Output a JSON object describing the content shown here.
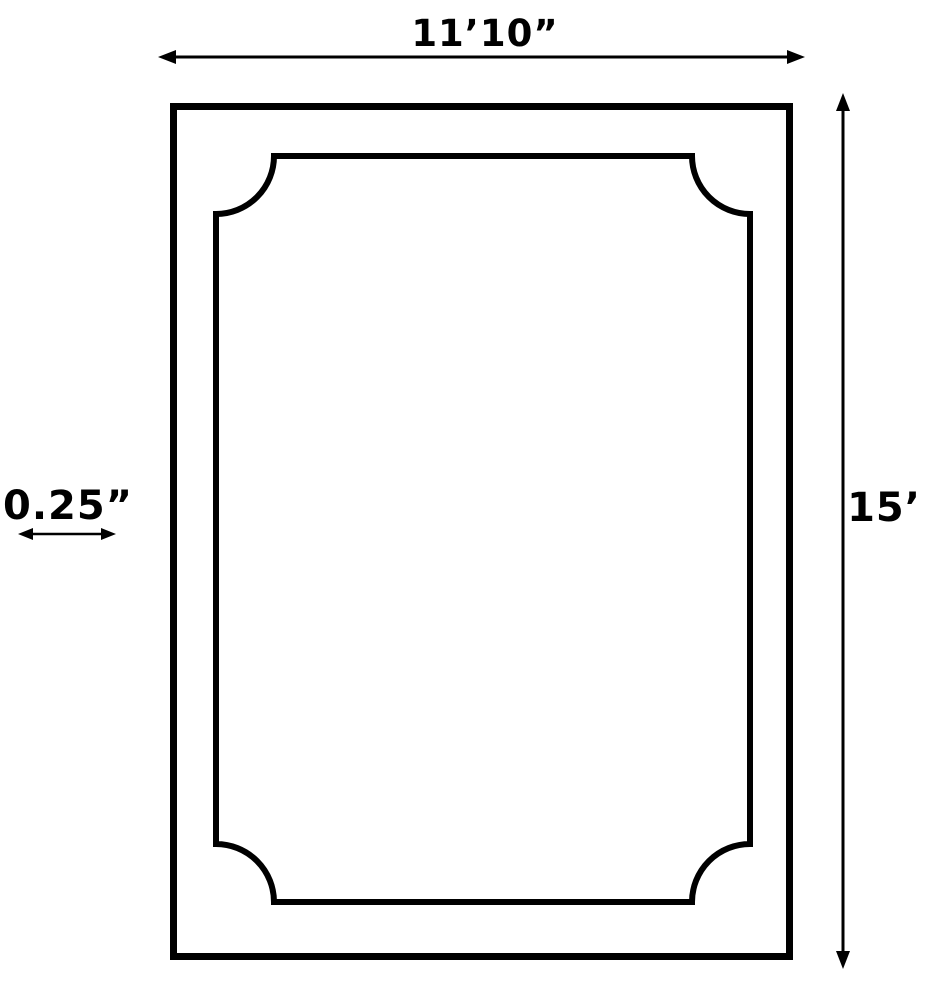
{
  "diagram": {
    "type": "dimension-drawing",
    "background_color": "#ffffff",
    "line_color": "#000000",
    "labels": {
      "width": "11’10”",
      "height": "15’",
      "border_thickness": "0.25”"
    },
    "dimensions": {
      "width_value": "11'10\"",
      "height_value": "15'",
      "border_thickness_value": "0.25\""
    }
  }
}
